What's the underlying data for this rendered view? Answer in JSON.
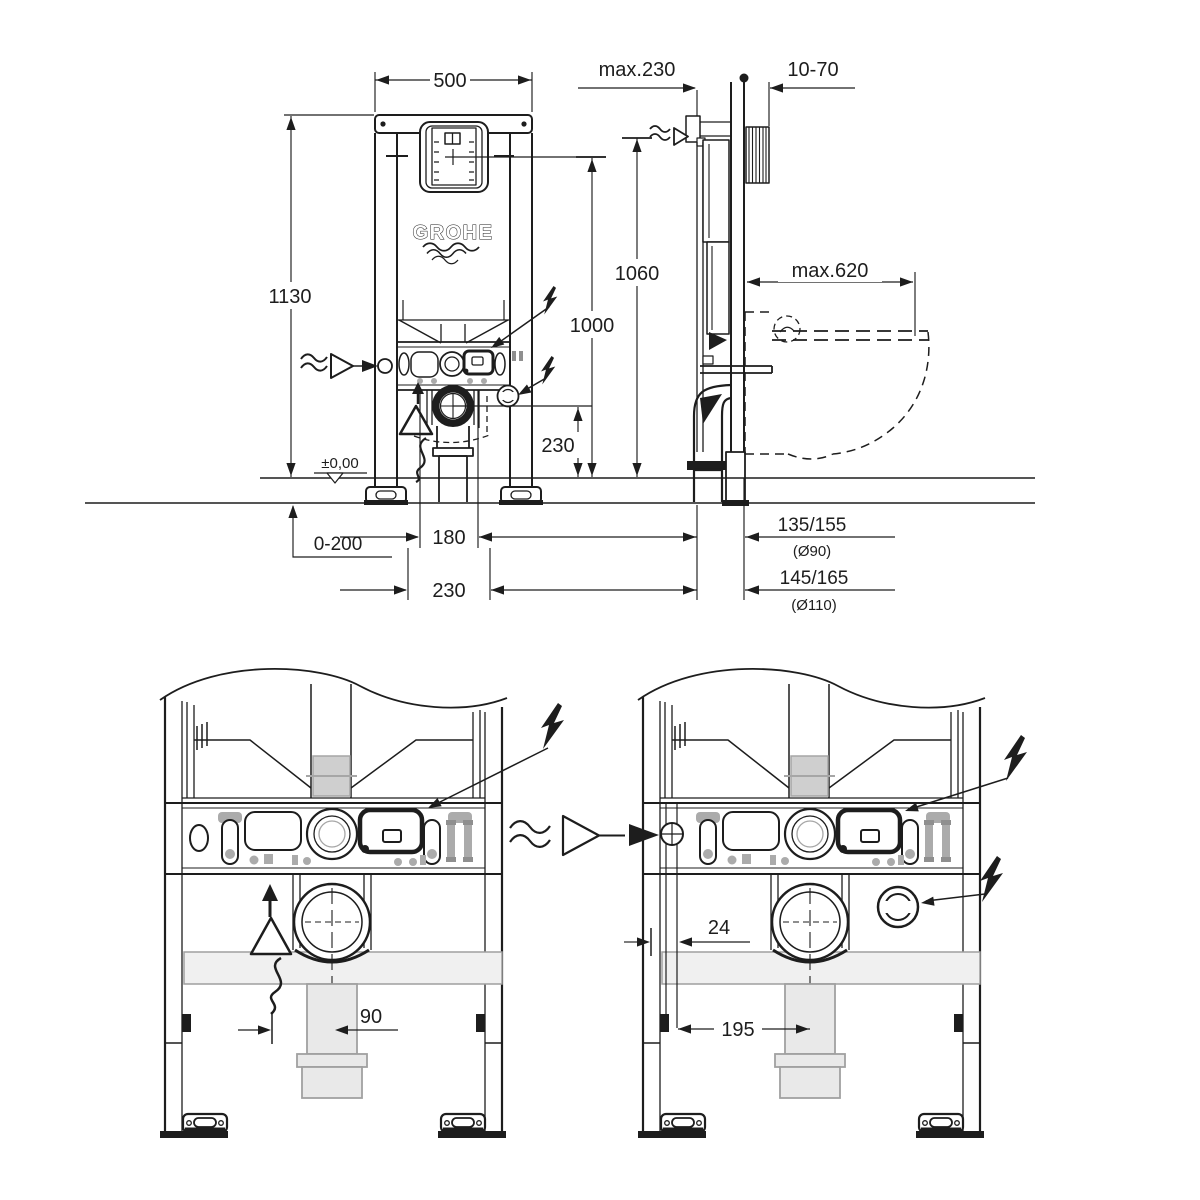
{
  "drawing": {
    "brand_logo": "GROHE",
    "front_view": {
      "width": "500",
      "height": "1130",
      "actuation_center_height": "1060",
      "service_opening_height": "1000",
      "drain_center_height": "230",
      "floor_level": "±0,00",
      "floor_buildup": "0-200",
      "fixing_spacing_inner": "180",
      "fixing_spacing_outer": "230"
    },
    "side_view": {
      "frame_depth": "max.230",
      "wall_distance": "10-70",
      "bowl_projection": "max.620",
      "drain_offset_d90": "135/155",
      "drain_pipe_d90": "(Ø90)",
      "drain_offset_d110": "145/165",
      "drain_pipe_d110": "(Ø110)"
    },
    "detail_view_left": {
      "drain_lateral_offset": "90"
    },
    "detail_view_right": {
      "supply_edge_offset": "24",
      "supply_to_drain_spacing": "195"
    },
    "icons": {
      "lightning": "electrical-connection",
      "wavy_arrow": "water-supply-connection",
      "warning_triangle": "attention-marker",
      "squiggle": "flexible-connection",
      "level_marker": "finished-floor-level"
    },
    "colors": {
      "line": "#1d1d1d",
      "gray": "#ababab",
      "light_gray": "#f0f0f0",
      "background": "#ffffff"
    }
  }
}
